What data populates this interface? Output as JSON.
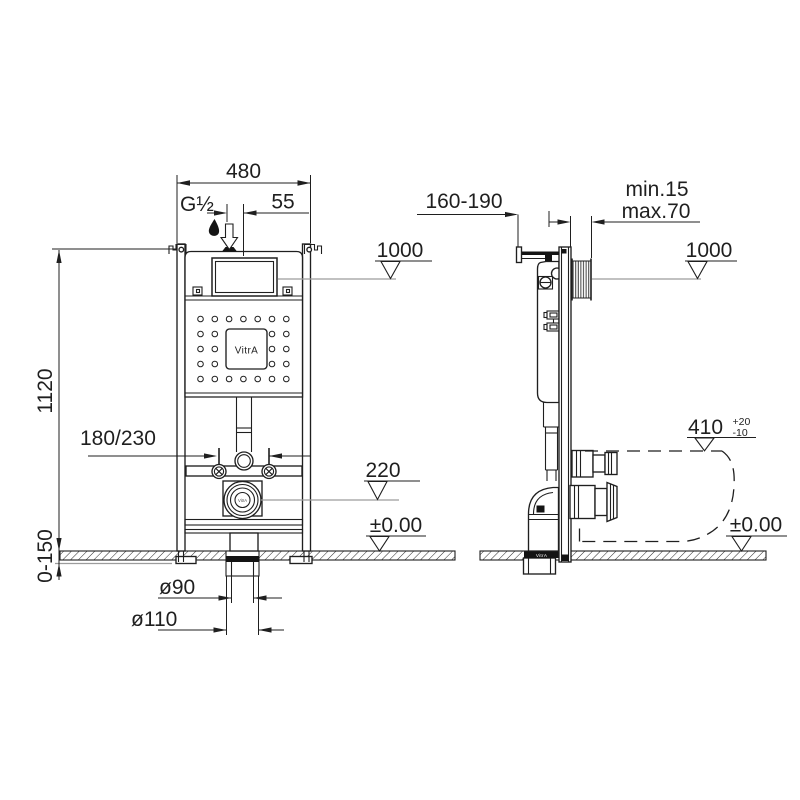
{
  "drawing": {
    "brand": "VitrA",
    "front": {
      "width": "480",
      "inlet_thread": "G½",
      "inlet_offset": "55",
      "level_flush": "1000",
      "height": "1120",
      "fixing_spacing": "180/230",
      "level_drain": "220",
      "level_floor": "±0.00",
      "floor_buildup": "0-150",
      "drain_dia": "ø90",
      "sleeve_dia": "ø110",
      "logo": "VitrA",
      "flange_label": "VitrA"
    },
    "side": {
      "depth_range": "160-190",
      "finish_min": "min.15",
      "finish_max": "max.70",
      "level_flush": "1000",
      "bowl_height": "410",
      "bowl_height_tol_plus": "+20",
      "bowl_height_tol_minus": "-10",
      "level_floor": "±0.00",
      "collar_label": "VitrA"
    }
  }
}
